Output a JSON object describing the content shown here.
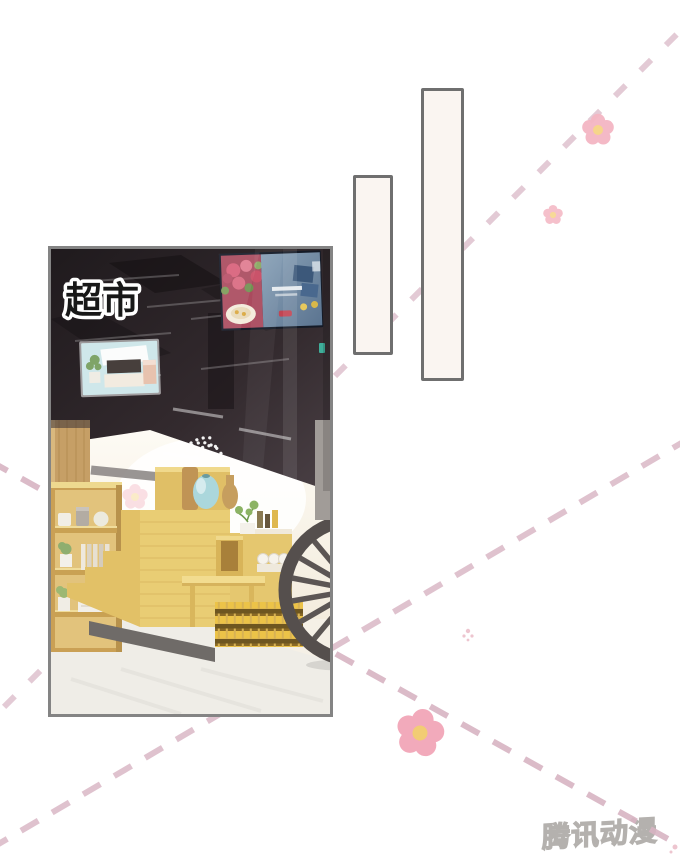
{
  "panel": {
    "label": "超市",
    "scene": "supermarket-interior"
  },
  "bubbles": [
    {
      "text": ""
    },
    {
      "text": ""
    }
  ],
  "watermark": {
    "text": "腾讯动漫"
  },
  "colors": {
    "dash-pink": "#d8b4c3",
    "dash-pink-light": "#ddbecb",
    "petal-pink": "#f4b6c3",
    "petal-pink-strong": "#f2aabb",
    "flower-center": "#f6d385",
    "flower-center-strong": "#f2cc74",
    "bubble-fill": "#faf5f1",
    "bubble-border": "#6f6f6f",
    "panel-border": "#848484",
    "wood-light": "#e9cd74",
    "ceiling-dark": "#241e21",
    "watermark-stroke": "#a8a4a0"
  }
}
